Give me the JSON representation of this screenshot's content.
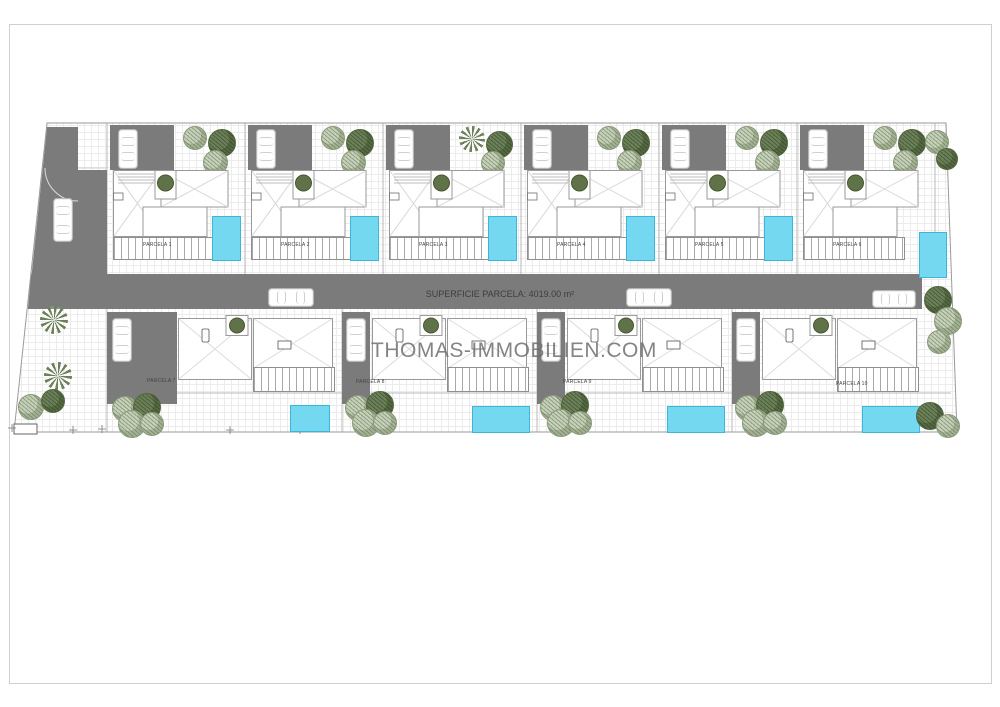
{
  "watermark": {
    "text": "THOMAS-IMMOBILIEN.COM"
  },
  "road": {
    "area_label": "SUPERFICIE PARCELA: 4019.00 m²"
  },
  "parcels": {
    "top": [
      {
        "label": "PARCELA 1"
      },
      {
        "label": "PARCELA 2"
      },
      {
        "label": "PARCELA 3"
      },
      {
        "label": "PARCELA 4"
      },
      {
        "label": "PARCELA 5"
      },
      {
        "label": "PARCELA 6"
      }
    ],
    "bottom": [
      {
        "label": "PARCELA 7"
      },
      {
        "label": "PARCELA 8"
      },
      {
        "label": "PARCELA 9"
      },
      {
        "label": "PARCELA 10"
      }
    ]
  },
  "colors": {
    "road": "#7b7b7b",
    "pool": "#74d9f0",
    "pool_border": "#3fb6d8",
    "tree_light_a": "#c6d0ba",
    "tree_light_b": "#8fa07e",
    "tree_dark_a": "#6d8059",
    "tree_dark_b": "#49603c",
    "outline": "#9a9a9a",
    "label_text": "#3d3d3d",
    "watermark_text": "#6f6f6f"
  }
}
